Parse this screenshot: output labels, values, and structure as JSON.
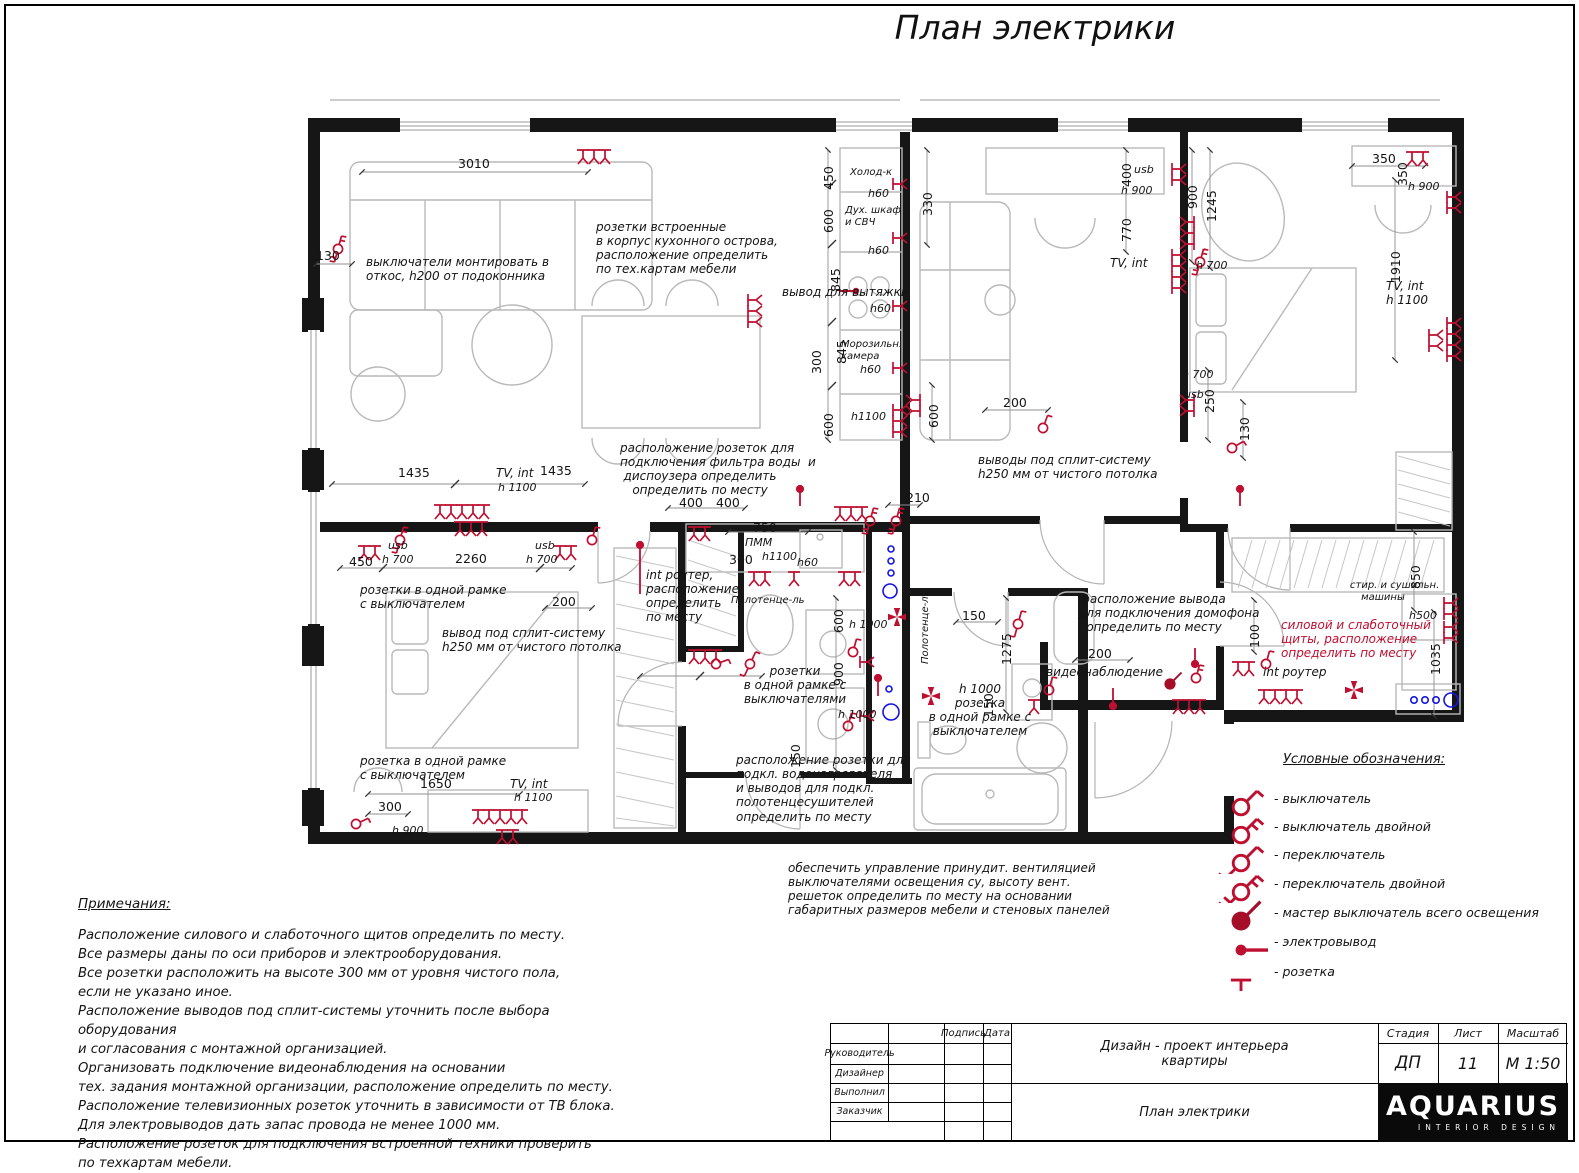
{
  "sheet": {
    "title": "План электрики"
  },
  "colors": {
    "accent": "#bf0f30",
    "master": "#a50d28",
    "plumbing": "#1414e0",
    "walls": "#161616"
  },
  "plan": {
    "labels": [
      {
        "t": "3010",
        "x": 458,
        "y": 157,
        "k": "d"
      },
      {
        "t": "130",
        "x": 316,
        "y": 249,
        "k": "d"
      },
      {
        "t": "выключатели монтировать в\nоткос, h200 от подоконника",
        "x": 366,
        "y": 255,
        "k": "a"
      },
      {
        "t": "розетки встроенные\nв корпус кухонного острова,\nрасположение определить\nпо тех.картам мебели",
        "x": 596,
        "y": 220,
        "k": "a"
      },
      {
        "t": "вывод для вытяжки",
        "x": 782,
        "y": 285,
        "k": "a"
      },
      {
        "t": "Холод-к",
        "x": 850,
        "y": 167,
        "k": "s"
      },
      {
        "t": "h60",
        "x": 868,
        "y": 188,
        "k": "s2"
      },
      {
        "t": "Дух. шкаф\nи СВЧ",
        "x": 845,
        "y": 205,
        "k": "s"
      },
      {
        "t": "h60",
        "x": 868,
        "y": 245,
        "k": "s2"
      },
      {
        "t": "h60",
        "x": 870,
        "y": 303,
        "k": "s2"
      },
      {
        "t": "Морозильн.\nкамера",
        "x": 841,
        "y": 339,
        "k": "s"
      },
      {
        "t": "h60",
        "x": 860,
        "y": 364,
        "k": "s2"
      },
      {
        "t": "h1100",
        "x": 851,
        "y": 411,
        "k": "s2"
      },
      {
        "t": "450",
        "x": 822,
        "y": 190,
        "k": "dv"
      },
      {
        "t": "600",
        "x": 822,
        "y": 233,
        "k": "dv"
      },
      {
        "t": "845",
        "x": 829,
        "y": 292,
        "k": "dv"
      },
      {
        "t": "845",
        "x": 835,
        "y": 364,
        "k": "dv"
      },
      {
        "t": "300",
        "x": 810,
        "y": 374,
        "k": "dv"
      },
      {
        "t": "600",
        "x": 822,
        "y": 437,
        "k": "dv"
      },
      {
        "t": "330",
        "x": 921,
        "y": 216,
        "k": "dv"
      },
      {
        "t": "600",
        "x": 927,
        "y": 428,
        "k": "dv"
      },
      {
        "t": "200",
        "x": 1003,
        "y": 396,
        "k": "d"
      },
      {
        "t": "400",
        "x": 1120,
        "y": 187,
        "k": "dv"
      },
      {
        "t": "usb",
        "x": 1134,
        "y": 164,
        "k": "s2"
      },
      {
        "t": "h 900",
        "x": 1121,
        "y": 185,
        "k": "s2"
      },
      {
        "t": "770",
        "x": 1120,
        "y": 242,
        "k": "dv"
      },
      {
        "t": "TV, int",
        "x": 1110,
        "y": 256,
        "k": "a"
      },
      {
        "t": "900",
        "x": 1186,
        "y": 209,
        "k": "dv"
      },
      {
        "t": "1245",
        "x": 1205,
        "y": 222,
        "k": "dv"
      },
      {
        "t": "h 700",
        "x": 1196,
        "y": 260,
        "k": "s2"
      },
      {
        "t": "350",
        "x": 1372,
        "y": 152,
        "k": "d"
      },
      {
        "t": "350",
        "x": 1396,
        "y": 186,
        "k": "dv"
      },
      {
        "t": "h 900",
        "x": 1408,
        "y": 181,
        "k": "s2"
      },
      {
        "t": "1910",
        "x": 1389,
        "y": 283,
        "k": "dv"
      },
      {
        "t": "TV, int\nh 1100",
        "x": 1386,
        "y": 279,
        "k": "a"
      },
      {
        "t": "h 700",
        "x": 1182,
        "y": 369,
        "k": "s2"
      },
      {
        "t": "usb",
        "x": 1184,
        "y": 389,
        "k": "s2"
      },
      {
        "t": "250",
        "x": 1203,
        "y": 413,
        "k": "dv"
      },
      {
        "t": "130",
        "x": 1238,
        "y": 441,
        "k": "dv"
      },
      {
        "t": "расположение розеток для\nподключения фильтра воды  и\nдиспоузера определить\nопределить по месту",
        "x": 620,
        "y": 441,
        "k": "ac",
        "w": 160
      },
      {
        "t": "выводы под сплит-систему\nh250 мм от чистого потолка",
        "x": 978,
        "y": 453,
        "k": "a"
      },
      {
        "t": "1435",
        "x": 398,
        "y": 466,
        "k": "d"
      },
      {
        "t": "TV, int",
        "x": 496,
        "y": 466,
        "k": "a"
      },
      {
        "t": "1435",
        "x": 540,
        "y": 464,
        "k": "d"
      },
      {
        "t": "h 1100",
        "x": 498,
        "y": 482,
        "k": "s2"
      },
      {
        "t": "450",
        "x": 349,
        "y": 555,
        "k": "d"
      },
      {
        "t": "usb",
        "x": 388,
        "y": 540,
        "k": "s2"
      },
      {
        "t": "h 700",
        "x": 382,
        "y": 554,
        "k": "s2"
      },
      {
        "t": "2260",
        "x": 455,
        "y": 552,
        "k": "d"
      },
      {
        "t": "usb",
        "x": 535,
        "y": 540,
        "k": "s2"
      },
      {
        "t": "h 700",
        "x": 526,
        "y": 554,
        "k": "s2"
      },
      {
        "t": "розетки в одной рамке\nс выключателем",
        "x": 360,
        "y": 583,
        "k": "a"
      },
      {
        "t": "200",
        "x": 552,
        "y": 595,
        "k": "d"
      },
      {
        "t": "вывод под сплит-систему\nh250 мм от чистого потолка",
        "x": 442,
        "y": 626,
        "k": "a"
      },
      {
        "t": "400",
        "x": 679,
        "y": 496,
        "k": "d"
      },
      {
        "t": "400",
        "x": 716,
        "y": 496,
        "k": "d"
      },
      {
        "t": "750",
        "x": 753,
        "y": 521,
        "k": "d"
      },
      {
        "t": "ПММ",
        "x": 745,
        "y": 537,
        "k": "s2"
      },
      {
        "t": "300",
        "x": 729,
        "y": 553,
        "k": "d"
      },
      {
        "t": "h1100",
        "x": 762,
        "y": 551,
        "k": "s2"
      },
      {
        "t": "h60",
        "x": 797,
        "y": 557,
        "k": "s2"
      },
      {
        "t": "210",
        "x": 906,
        "y": 491,
        "k": "d"
      },
      {
        "t": "int роутер,\nрасположение\nопределить\nпо месту",
        "x": 646,
        "y": 568,
        "k": "a"
      },
      {
        "t": "Полотенце-ль",
        "x": 731,
        "y": 595,
        "k": "s"
      },
      {
        "t": "600",
        "x": 832,
        "y": 633,
        "k": "dv"
      },
      {
        "t": "h 1000",
        "x": 849,
        "y": 619,
        "k": "s2"
      },
      {
        "t": "900",
        "x": 832,
        "y": 686,
        "k": "dv"
      },
      {
        "t": "розетки\nв одной рамке с\nвыключателями",
        "x": 740,
        "y": 664,
        "k": "ac",
        "w": 110
      },
      {
        "t": "h 1000",
        "x": 838,
        "y": 709,
        "k": "s2"
      },
      {
        "t": "150",
        "x": 789,
        "y": 768,
        "k": "dv"
      },
      {
        "t": "расположение розетки для\nподкл. водонагревателя\nи выводов для подкл.\nполотенцесушителей\nопределить по месту",
        "x": 736,
        "y": 753,
        "k": "a"
      },
      {
        "t": "Полотенце-ль",
        "x": 920,
        "y": 664,
        "k": "sv"
      },
      {
        "t": "150",
        "x": 962,
        "y": 609,
        "k": "d"
      },
      {
        "t": "1275",
        "x": 1000,
        "y": 665,
        "k": "dv"
      },
      {
        "t": "150",
        "x": 982,
        "y": 717,
        "k": "dv"
      },
      {
        "t": "h 1000\nрозетка\nв одной рамке с\nвыключателем",
        "x": 918,
        "y": 682,
        "k": "ac",
        "w": 124
      },
      {
        "t": "видеонаблюдение",
        "x": 1046,
        "y": 665,
        "k": "a"
      },
      {
        "t": "расположение вывода\nдля подключения домофона\nопределить по месту",
        "x": 1078,
        "y": 592,
        "k": "ac",
        "w": 152
      },
      {
        "t": "200",
        "x": 1088,
        "y": 647,
        "k": "d"
      },
      {
        "t": "100",
        "x": 1248,
        "y": 648,
        "k": "dv"
      },
      {
        "t": "силовой и слаботочный\nщиты, расположение\nопределить по месту",
        "x": 1281,
        "y": 618,
        "k": "a",
        "c": "red"
      },
      {
        "t": "int роутер",
        "x": 1263,
        "y": 665,
        "k": "a"
      },
      {
        "t": "стир. и сушильн.\nмашины",
        "x": 1350,
        "y": 580,
        "k": "sc",
        "w": 66
      },
      {
        "t": "h500",
        "x": 1409,
        "y": 610,
        "k": "s2"
      },
      {
        "t": "850",
        "x": 1409,
        "y": 589,
        "k": "dv"
      },
      {
        "t": "1035",
        "x": 1429,
        "y": 675,
        "k": "dv"
      },
      {
        "t": "розетка в одной рамке\nс выключателем",
        "x": 360,
        "y": 754,
        "k": "a"
      },
      {
        "t": "1650",
        "x": 420,
        "y": 777,
        "k": "d"
      },
      {
        "t": "300",
        "x": 378,
        "y": 800,
        "k": "d"
      },
      {
        "t": "h 900",
        "x": 392,
        "y": 825,
        "k": "s2"
      },
      {
        "t": "TV, int",
        "x": 510,
        "y": 777,
        "k": "a"
      },
      {
        "t": "h 1100",
        "x": 514,
        "y": 792,
        "k": "s2"
      },
      {
        "t": "обеспечить управление принудит. вентиляцией\nвыключателями освещения су, высоту вент.\nрешеток определить по месту на основании\nгабаритных размеров мебели и стеновых панелей",
        "x": 788,
        "y": 861,
        "k": "a"
      }
    ]
  },
  "legend": {
    "title": "Условные обозначения:",
    "items": [
      {
        "symbol": "switch",
        "label": "- выключатель"
      },
      {
        "symbol": "switch-double",
        "label": "- выключатель двойной"
      },
      {
        "symbol": "changeover",
        "label": "- переключатель"
      },
      {
        "symbol": "changeover-double",
        "label": "- переключатель двойной"
      },
      {
        "symbol": "master",
        "label": "- мастер выключатель всего освещения"
      },
      {
        "symbol": "output",
        "label": "- электровывод"
      },
      {
        "symbol": "socket",
        "label": "- розетка"
      }
    ]
  },
  "notes": {
    "title": "Примечания:",
    "lines": [
      "Расположение силового и слаботочного щитов определить по месту.",
      "Все размеры даны по оси приборов и электрооборудования.",
      "Все розетки расположить на высоте 300 мм от уровня чистого пола,",
      "если не указано иное.",
      "Расположение выводов под сплит-системы уточнить после выбора оборудования",
      "и согласования с монтажной организацией.",
      "Организовать подключение видеонаблюдения на основании",
      "тех. задания монтажной организации, расположение определить по месту.",
      "Расположение телевизионных розеток уточнить в зависимости от ТВ блока.",
      "Для электровыводов дать запас провода не менее 1000 мм.",
      "Расположение розеток для подключения встроенной техники проверить",
      "по техкартам мебели."
    ]
  },
  "titleblock": {
    "rows": [
      "Руководитель",
      "Дизайнер",
      "Выполнил",
      "Заказчик"
    ],
    "signature": "Подпись",
    "date": "Дата",
    "project": "Дизайн - проект интерьера\nквартиры",
    "sheet_name": "План электрики",
    "stage_label": "Стадия",
    "stage": "ДП",
    "sheet_label": "Лист",
    "sheet": "11",
    "scale_label": "Масштаб",
    "scale": "М 1:50",
    "logo": "AQUARIUS",
    "logo_sub": "INTERIOR DESIGN"
  }
}
